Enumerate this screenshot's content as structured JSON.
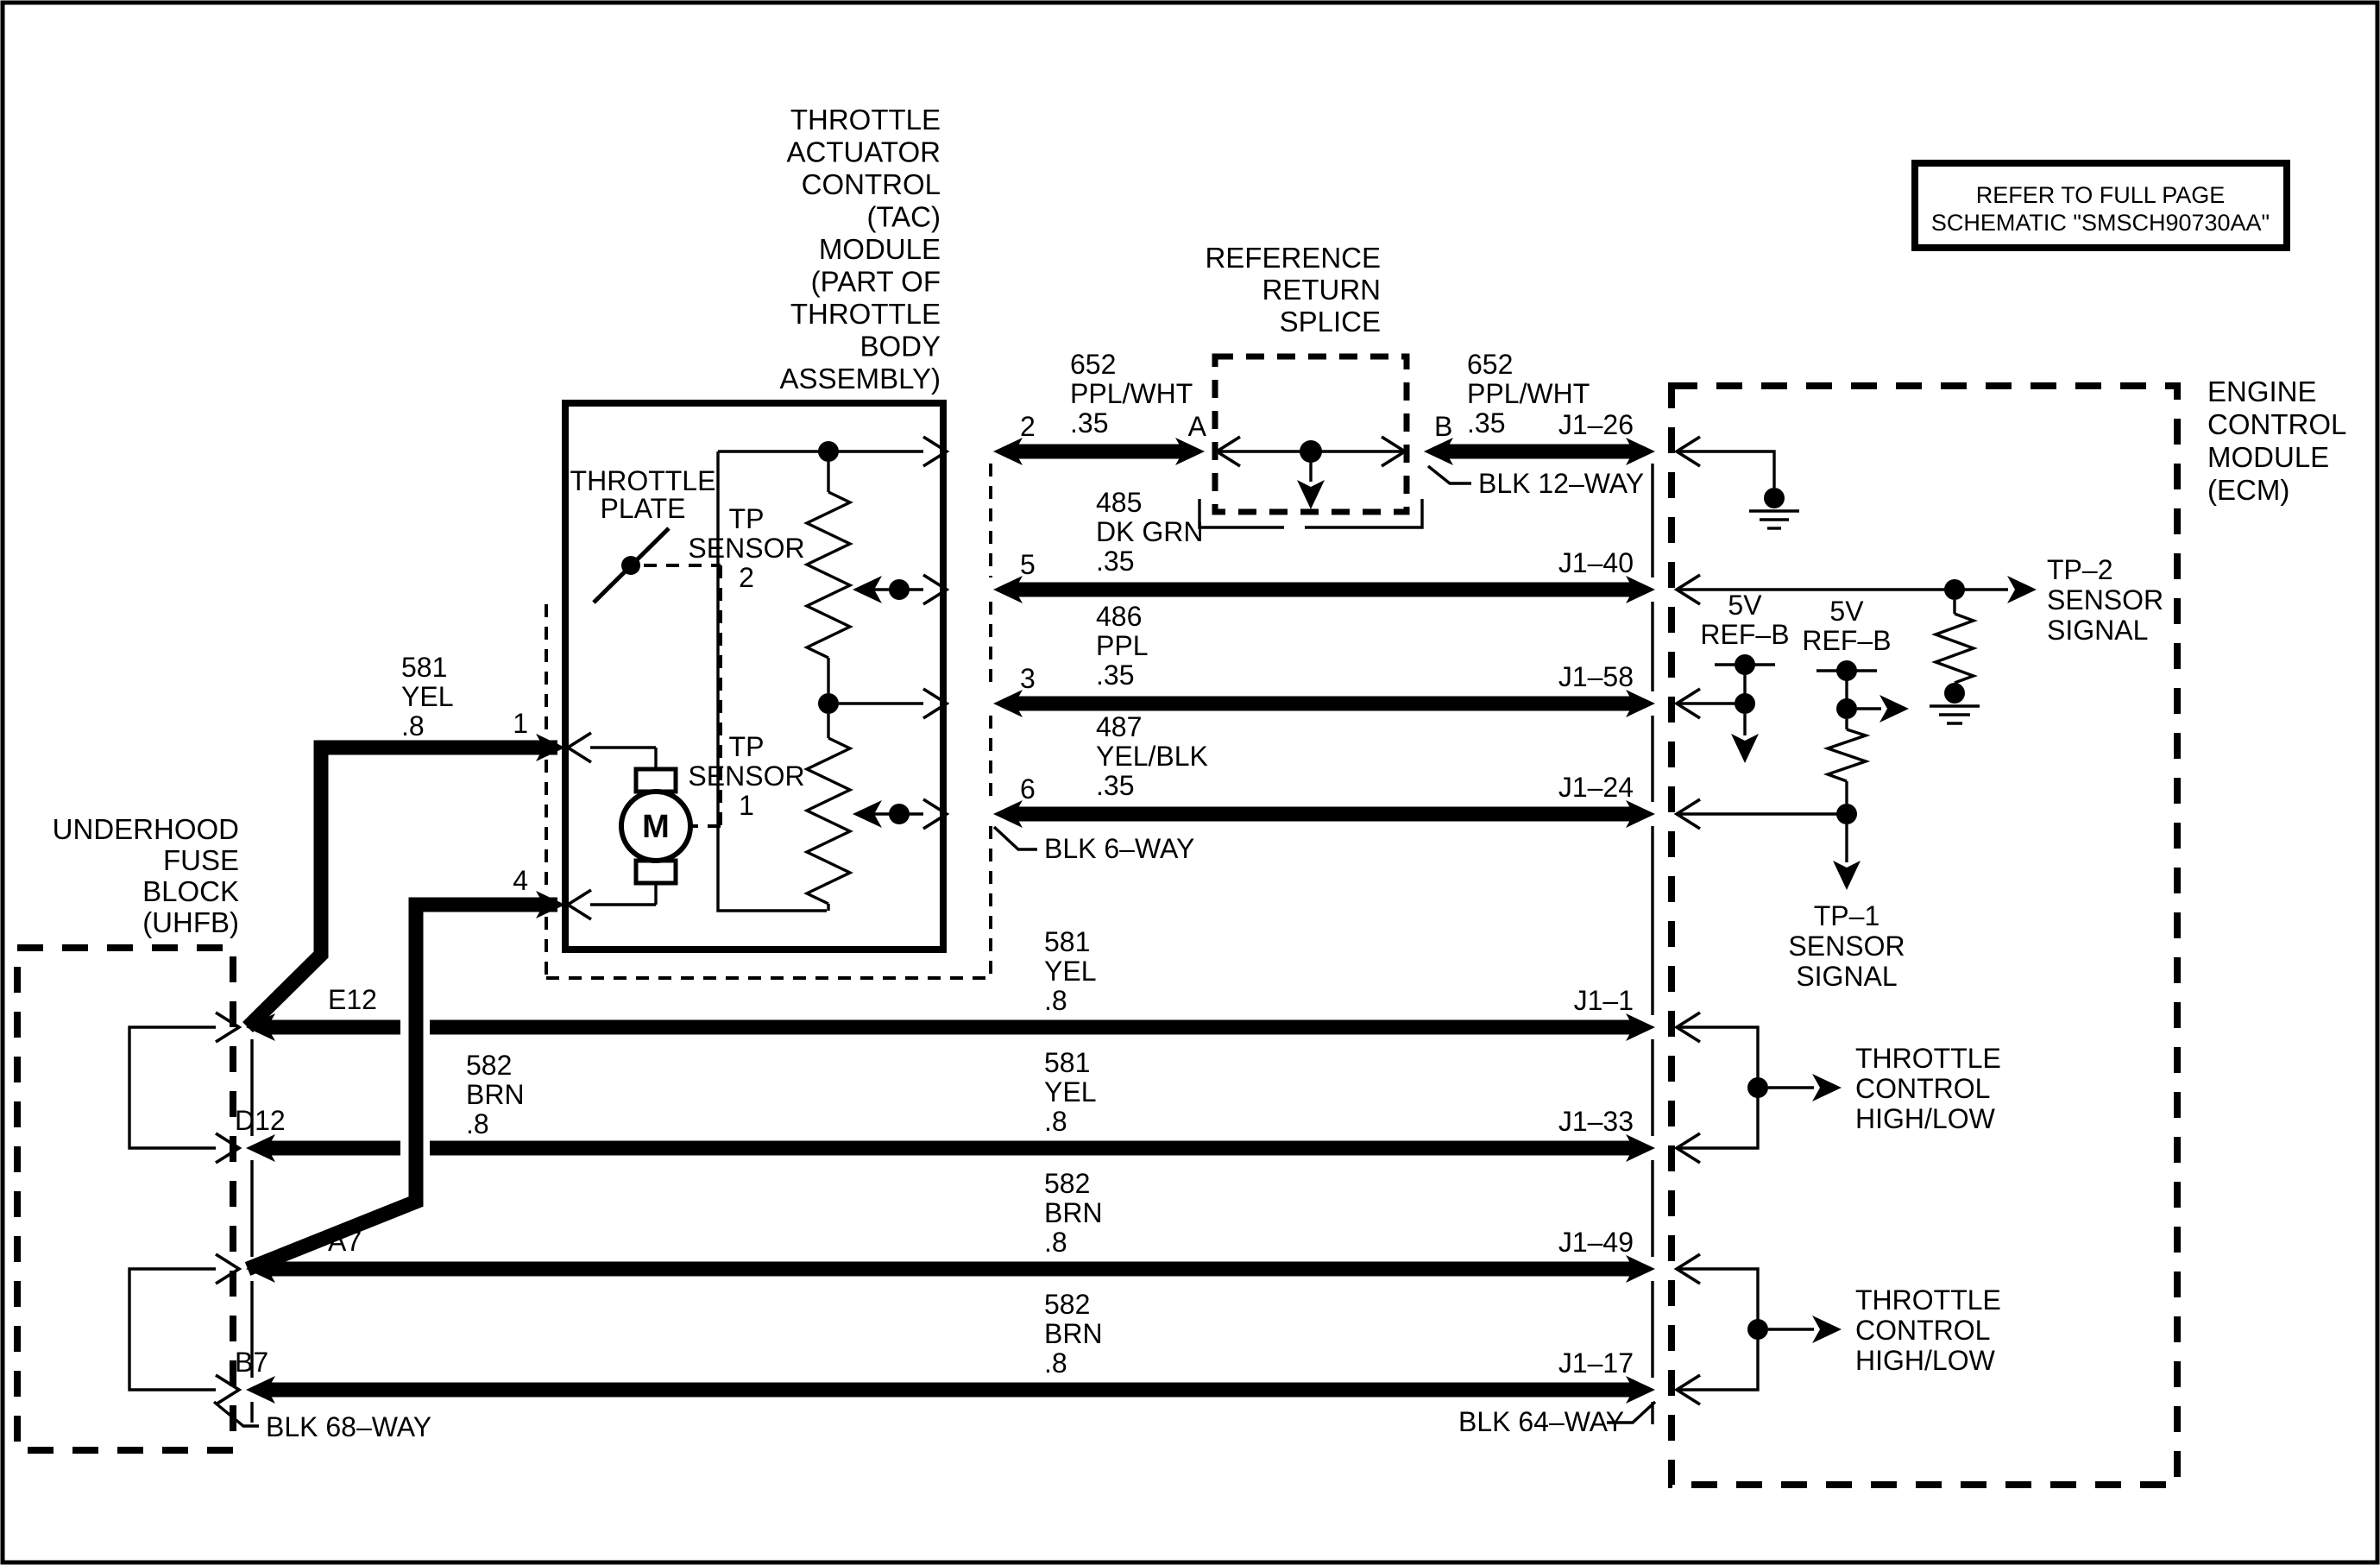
{
  "reference_note": {
    "line1": "REFER TO FULL PAGE",
    "line2": "SCHEMATIC \"SMSCH90730AA\""
  },
  "uhfb": {
    "name_lines": [
      "UNDERHOOD",
      "FUSE",
      "BLOCK",
      "(UHFB)"
    ],
    "terminals": {
      "e12": "E12",
      "d12": "D12",
      "a7": "A7",
      "b7": "B7"
    },
    "connector": "BLK 68–WAY"
  },
  "tac": {
    "name_lines": [
      "THROTTLE",
      "ACTUATOR",
      "CONTROL",
      "(TAC)",
      "MODULE",
      "(PART OF",
      "THROTTLE",
      "BODY",
      "ASSEMBLY)"
    ],
    "throttle_plate": {
      "l1": "THROTTLE",
      "l2": "PLATE"
    },
    "motor": "M",
    "tp_sensor_2": {
      "l1": "TP",
      "l2": "SENSOR",
      "l3": "2"
    },
    "tp_sensor_1": {
      "l1": "TP",
      "l2": "SENSOR",
      "l3": "1"
    },
    "pins": {
      "p1": "1",
      "p2": "2",
      "p3": "3",
      "p4": "4",
      "p5": "5",
      "p6": "6"
    },
    "connector": "BLK 6–WAY"
  },
  "splice": {
    "name_lines": [
      "REFERENCE",
      "RETURN",
      "SPLICE"
    ],
    "terminals": {
      "a": "A",
      "b": "B"
    },
    "connector": "BLK 12–WAY"
  },
  "ecm": {
    "name_lines": [
      "ENGINE",
      "CONTROL",
      "MODULE",
      "(ECM)"
    ],
    "terminals": {
      "j26": "J1–26",
      "j40": "J1–40",
      "j58": "J1–58",
      "j24": "J1–24",
      "j1": "J1–1",
      "j33": "J1–33",
      "j49": "J1–49",
      "j17": "J1–17"
    },
    "connector": "BLK 64–WAY",
    "signals": {
      "ref_b1": {
        "l1": "5V",
        "l2": "REF–B"
      },
      "ref_b2": {
        "l1": "5V",
        "l2": "REF–B"
      },
      "tp2": {
        "l1": "TP–2",
        "l2": "SENSOR",
        "l3": "SIGNAL"
      },
      "tp1": {
        "l1": "TP–1",
        "l2": "SENSOR",
        "l3": "SIGNAL"
      },
      "tc1": {
        "l1": "THROTTLE",
        "l2": "CONTROL",
        "l3": "HIGH/LOW"
      },
      "tc2": {
        "l1": "THROTTLE",
        "l2": "CONTROL",
        "l3": "HIGH/LOW"
      }
    }
  },
  "wires": [
    {
      "circuit": "652",
      "color": "PPL/WHT",
      "gauge": ".35",
      "from": "TAC pin 2",
      "to": "splice A"
    },
    {
      "circuit": "652",
      "color": "PPL/WHT",
      "gauge": ".35",
      "from": "splice B",
      "to": "ECM J1–26"
    },
    {
      "circuit": "485",
      "color": "DK GRN",
      "gauge": ".35",
      "from": "TAC pin 5",
      "to": "ECM J1–40"
    },
    {
      "circuit": "486",
      "color": "PPL",
      "gauge": ".35",
      "from": "TAC pin 3",
      "to": "ECM J1–58"
    },
    {
      "circuit": "487",
      "color": "YEL/BLK",
      "gauge": ".35",
      "from": "TAC pin 6",
      "to": "ECM J1–24"
    },
    {
      "circuit": "581",
      "color": "YEL",
      "gauge": ".8",
      "from": "TAC pin 1",
      "to": "UHFB E12"
    },
    {
      "circuit": "581",
      "color": "YEL",
      "gauge": ".8",
      "from": "UHFB E12",
      "to": "ECM J1–1"
    },
    {
      "circuit": "581",
      "color": "YEL",
      "gauge": ".8",
      "from": "UHFB D12",
      "to": "ECM J1–33"
    },
    {
      "circuit": "582",
      "color": "BRN",
      "gauge": ".8",
      "from": "TAC pin 4",
      "to": "UHFB A7"
    },
    {
      "circuit": "582",
      "color": "BRN",
      "gauge": ".8",
      "from": "UHFB A7",
      "to": "ECM J1–49"
    },
    {
      "circuit": "582",
      "color": "BRN",
      "gauge": ".8",
      "from": "UHFB B7",
      "to": "ECM J1–17"
    }
  ],
  "colors": {
    "line": "#000000",
    "background": "#ffffff"
  }
}
